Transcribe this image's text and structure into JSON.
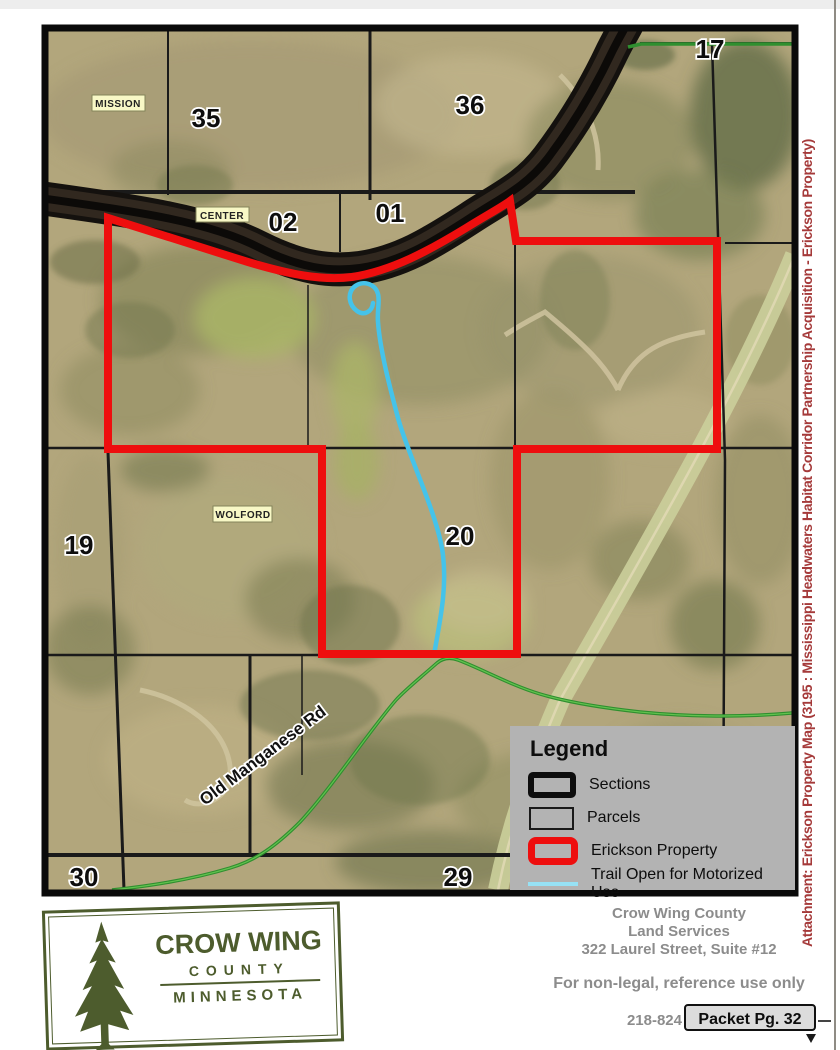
{
  "map": {
    "townships": {
      "mission": "MISSION",
      "center": "CENTER",
      "wolford": "WOLFORD"
    },
    "sections": {
      "s35": "35",
      "s36": "36",
      "s17": "17",
      "s02": "02",
      "s01": "01",
      "s19": "19",
      "s20": "20",
      "s30": "30",
      "s29": "29"
    },
    "road_label": "Old Manganese Rd"
  },
  "legend": {
    "title": "Legend",
    "items": [
      {
        "id": "sections",
        "label": "Sections"
      },
      {
        "id": "parcels",
        "label": "Parcels"
      },
      {
        "id": "erickson-property",
        "label": "Erickson Property"
      },
      {
        "id": "trail",
        "label": "Trail Open for Motorized Use"
      }
    ]
  },
  "attachment_sidebar": {
    "text": "Attachment: Erickson Property Map (3195 : Mississippi Headwaters Habitat Corridor Partnership Acquisition - Erickson Property)"
  },
  "logo": {
    "name": "CROW WING",
    "subtitle": "COUNTY",
    "state": "MINNESOTA"
  },
  "footer": {
    "org_line1": "Crow Wing County",
    "org_line2": "Land Services",
    "org_line3": "322 Laurel Street, Suite #12",
    "disclaimer": "For non-legal, reference use only",
    "phone_partial": "218-824",
    "packet_badge": "Packet Pg. 32"
  },
  "colors": {
    "property_red": "#ee0e0e",
    "trail_blue": "#45c3ea",
    "road_green": "#2f8f2f",
    "legend_bg": "#b3b3b3",
    "attachment_red": "#a53a3a",
    "logo_green": "#4d5c2d"
  }
}
